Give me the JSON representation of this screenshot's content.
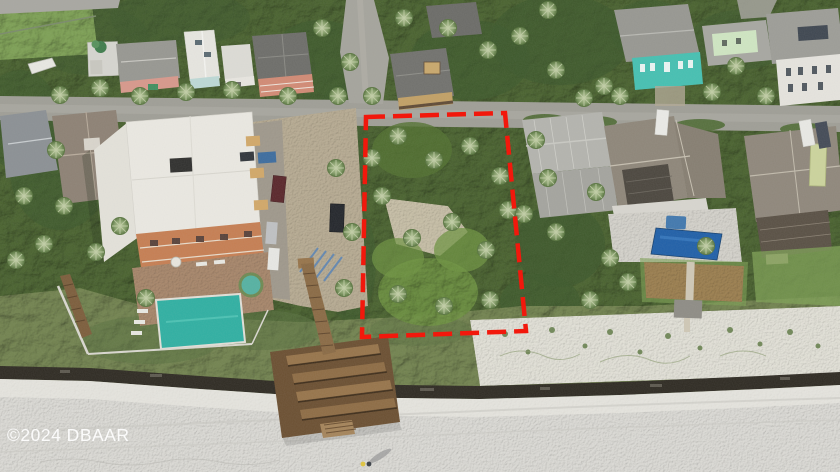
{
  "watermark": {
    "text": "©2024 DBAAR",
    "color": "#ffffff"
  },
  "colors": {
    "outline_red": "#f2180c",
    "canopy": "#49622f",
    "dune_veg": "#72834f",
    "lawn": "#7da054",
    "brown_lawn": "#9c7f4f",
    "street": "#9f9e96",
    "driveway": "#b8ac93",
    "beach": "#dcdbd6",
    "dune_sand": "#e8e6de",
    "seawall": "#2e2a22",
    "boardwalk": "#6b4f31",
    "condo_roof": "#ebe9e2",
    "condo_wall": "#c67e52",
    "patio": "#a8876b",
    "condo_pool": "#2fb0a2",
    "spa": "#55b2a2",
    "right_pool": "#1f5fa8",
    "teal_house": "#45c0b2",
    "pink_house": "#d8988b",
    "salmon_house": "#d28a74",
    "mint_house": "#cfe6c2",
    "metal_roof": "#b4b4ae",
    "shingle_roof": "#8e8679",
    "white_roof": "#e7e6e0",
    "gray_roof": "#979791",
    "dark_roof": "#6d6d69"
  }
}
